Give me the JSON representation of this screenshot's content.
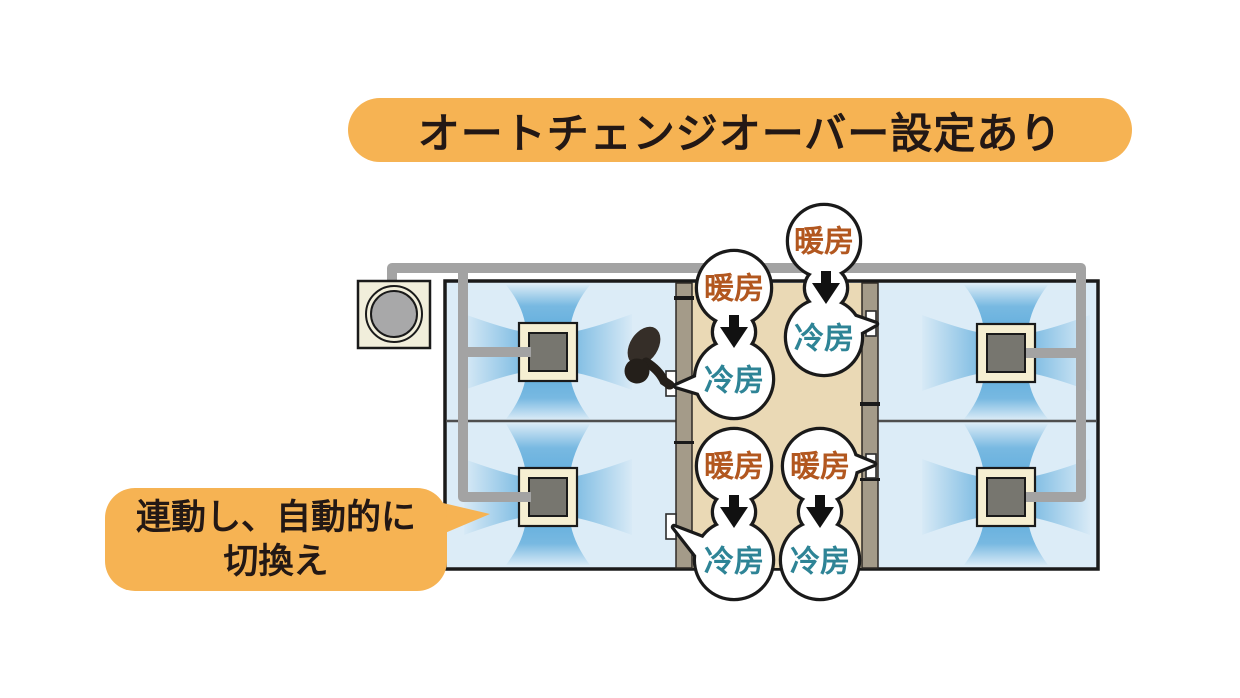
{
  "title": {
    "text": "オートチェンジオーバー設定あり"
  },
  "callout": {
    "line1": "連動し、自動的に",
    "line2": "切換え"
  },
  "modes": {
    "heating": "暖房",
    "cooling": "冷房"
  },
  "bubbles": [
    {
      "location": "corridor-upper-left",
      "from": "暖房",
      "to": "冷房"
    },
    {
      "location": "corridor-upper-right",
      "from": "暖房",
      "to": "冷房"
    },
    {
      "location": "corridor-lower-left",
      "from": "暖房",
      "to": "冷房"
    },
    {
      "location": "corridor-lower-right",
      "from": "暖房",
      "to": "冷房"
    }
  ],
  "colors": {
    "highlight": "#F6B353",
    "text": "#231815",
    "heating_text": "#B2571F",
    "cooling_text": "#2E8496",
    "room": "#DCECF7",
    "airflow": "#4DA3D8",
    "corridor_floor": "#EAD9B5",
    "corridor_wall": "#A49B89",
    "unit_frame": "#F6EFD2",
    "unit_core": "#77766F",
    "pipe": "#A3A3A3",
    "outline": "#1A1A1A"
  }
}
